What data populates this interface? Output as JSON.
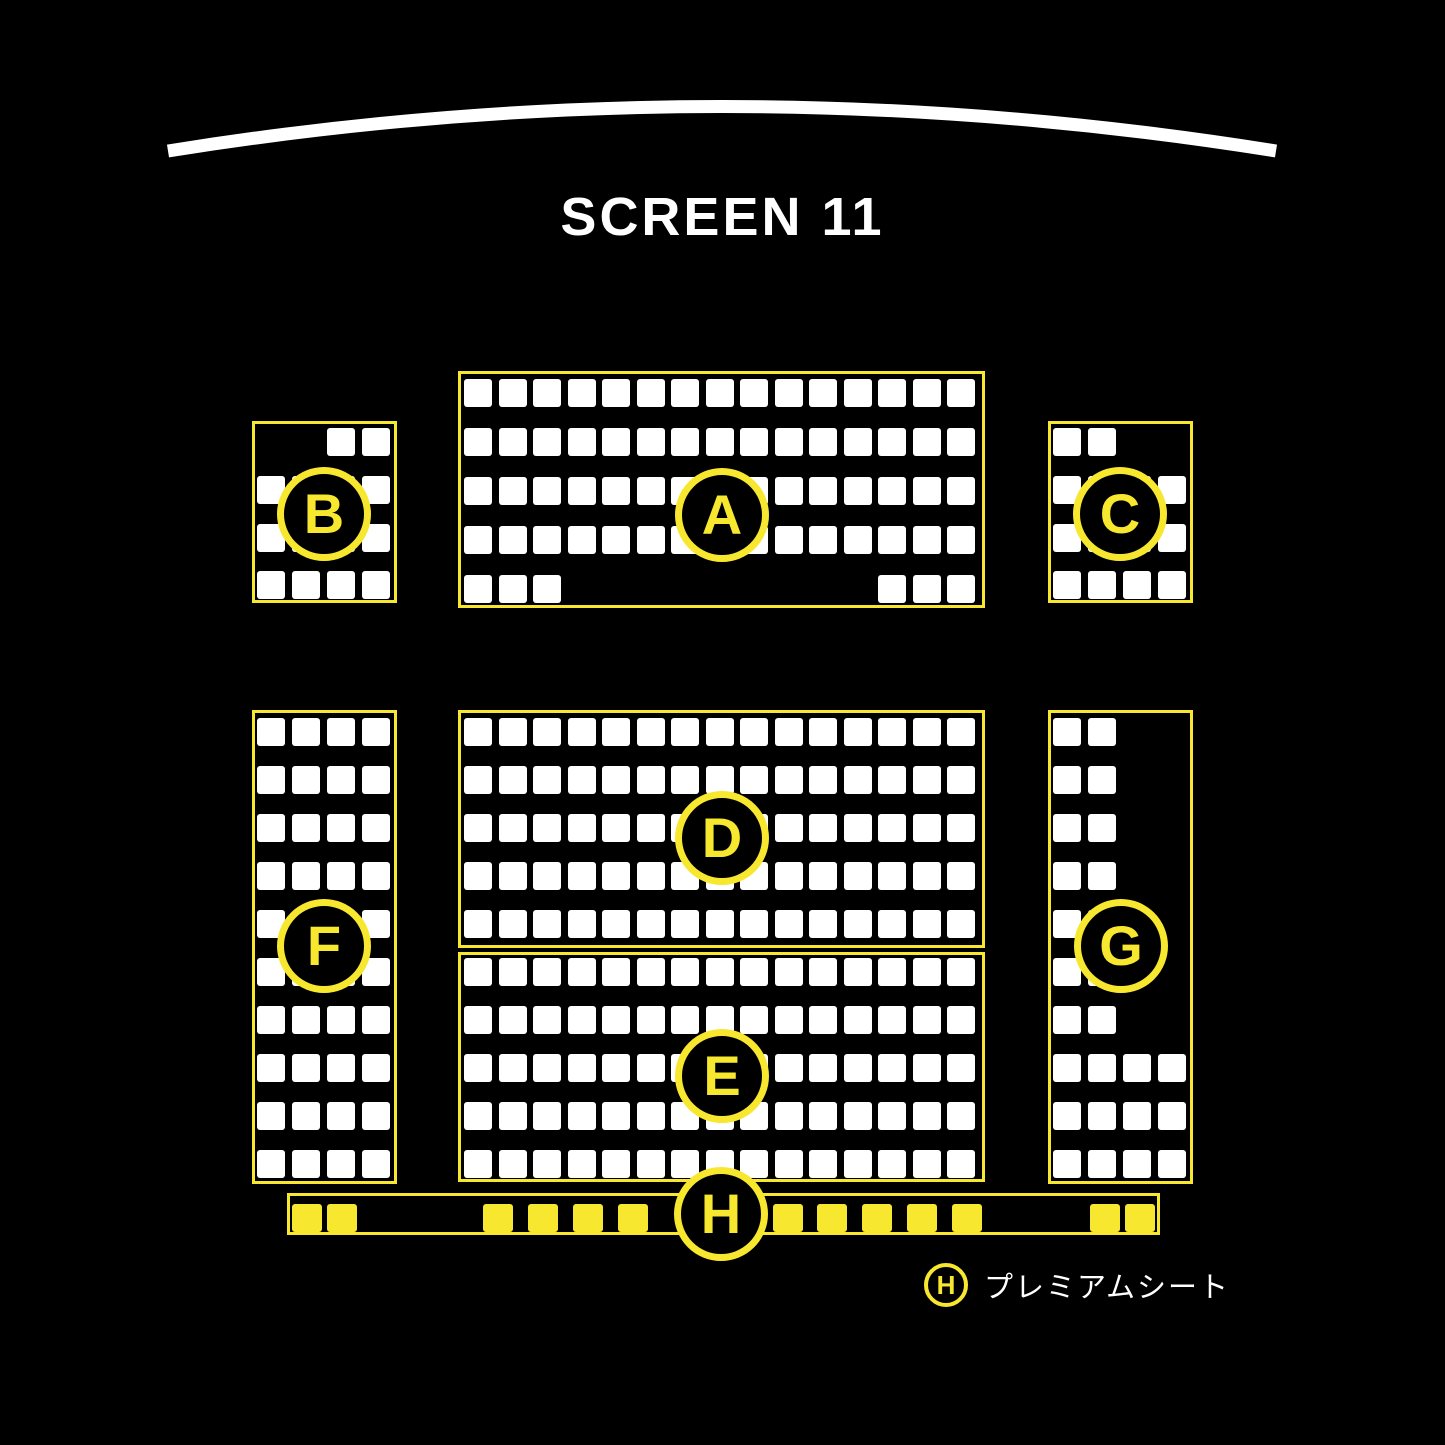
{
  "screen": {
    "title": "SCREEN 11"
  },
  "colors": {
    "accent_yellow": "#F7E82F",
    "seat_white": "#FFFFFF",
    "background": "#000000"
  },
  "legend": {
    "symbol": "H",
    "label": "プレミアムシート"
  },
  "arc": {
    "x1": 168,
    "y1": 151,
    "cx": 722,
    "cy": 62,
    "x2": 1276,
    "y2": 151,
    "stroke_width": 13
  },
  "sections": [
    {
      "label": "A",
      "seat_style": "standard",
      "seat_size": {
        "w": 28,
        "h": 28
      },
      "box": {
        "x": 458,
        "y": 371,
        "w": 527,
        "h": 237
      },
      "grid": {
        "col_start": 464,
        "col_pitch": 34.5,
        "col_count": 15,
        "rows": [
          {
            "y": 379,
            "cols": "all"
          },
          {
            "y": 428,
            "cols": "all"
          },
          {
            "y": 477,
            "cols": "all"
          },
          {
            "y": 526,
            "cols": "all"
          },
          {
            "y": 575,
            "cols": [
              1,
              2,
              3,
              13,
              14,
              15
            ]
          }
        ]
      },
      "circle": {
        "cx": 722,
        "cy": 515,
        "r": 47
      }
    },
    {
      "label": "B",
      "seat_style": "standard",
      "seat_size": {
        "w": 28,
        "h": 28
      },
      "box": {
        "x": 252,
        "y": 421,
        "w": 145,
        "h": 182
      },
      "grid": {
        "col_start": 257,
        "col_pitch": 35,
        "col_count": 4,
        "rows": [
          {
            "y": 428,
            "cols": [
              3,
              4
            ]
          },
          {
            "y": 476,
            "cols": "all"
          },
          {
            "y": 524,
            "cols": "all"
          },
          {
            "y": 571,
            "cols": "all"
          }
        ]
      },
      "circle": {
        "cx": 324,
        "cy": 514,
        "r": 47
      }
    },
    {
      "label": "C",
      "seat_style": "standard",
      "seat_size": {
        "w": 28,
        "h": 28
      },
      "box": {
        "x": 1048,
        "y": 421,
        "w": 145,
        "h": 182
      },
      "grid": {
        "col_start": 1053,
        "col_pitch": 35,
        "col_count": 4,
        "rows": [
          {
            "y": 428,
            "cols": [
              1,
              2
            ]
          },
          {
            "y": 476,
            "cols": "all"
          },
          {
            "y": 524,
            "cols": "all"
          },
          {
            "y": 571,
            "cols": "all"
          }
        ]
      },
      "circle": {
        "cx": 1120,
        "cy": 514,
        "r": 47
      }
    },
    {
      "label": "D",
      "seat_style": "standard",
      "seat_size": {
        "w": 28,
        "h": 28
      },
      "box": {
        "x": 458,
        "y": 710,
        "w": 527,
        "h": 238
      },
      "grid": {
        "col_start": 464,
        "col_pitch": 34.5,
        "col_count": 15,
        "rows": [
          {
            "y": 718,
            "cols": "all"
          },
          {
            "y": 766,
            "cols": "all"
          },
          {
            "y": 814,
            "cols": "all"
          },
          {
            "y": 862,
            "cols": "all"
          },
          {
            "y": 910,
            "cols": "all"
          }
        ]
      },
      "circle": {
        "cx": 722,
        "cy": 838,
        "r": 47
      }
    },
    {
      "label": "E",
      "seat_style": "standard",
      "seat_size": {
        "w": 28,
        "h": 28
      },
      "box": {
        "x": 458,
        "y": 952,
        "w": 527,
        "h": 230
      },
      "grid": {
        "col_start": 464,
        "col_pitch": 34.5,
        "col_count": 15,
        "rows": [
          {
            "y": 958,
            "cols": "all"
          },
          {
            "y": 1006,
            "cols": "all"
          },
          {
            "y": 1054,
            "cols": "all"
          },
          {
            "y": 1102,
            "cols": "all"
          },
          {
            "y": 1150,
            "cols": "all"
          }
        ]
      },
      "circle": {
        "cx": 722,
        "cy": 1076,
        "r": 47
      }
    },
    {
      "label": "F",
      "seat_style": "standard",
      "seat_size": {
        "w": 28,
        "h": 28
      },
      "box": {
        "x": 252,
        "y": 710,
        "w": 145,
        "h": 474
      },
      "grid": {
        "col_start": 257,
        "col_pitch": 35,
        "col_count": 4,
        "rows": [
          {
            "y": 718,
            "cols": "all"
          },
          {
            "y": 766,
            "cols": "all"
          },
          {
            "y": 814,
            "cols": "all"
          },
          {
            "y": 862,
            "cols": "all"
          },
          {
            "y": 910,
            "cols": "all"
          },
          {
            "y": 958,
            "cols": "all"
          },
          {
            "y": 1006,
            "cols": "all"
          },
          {
            "y": 1054,
            "cols": "all"
          },
          {
            "y": 1102,
            "cols": "all"
          },
          {
            "y": 1150,
            "cols": "all"
          }
        ]
      },
      "circle": {
        "cx": 324,
        "cy": 946,
        "r": 47
      }
    },
    {
      "label": "G",
      "seat_style": "standard",
      "seat_size": {
        "w": 28,
        "h": 28
      },
      "box": {
        "x": 1048,
        "y": 710,
        "w": 145,
        "h": 474
      },
      "grid": {
        "col_start": 1053,
        "col_pitch": 35,
        "col_count": 4,
        "rows": [
          {
            "y": 718,
            "cols": [
              1,
              2
            ]
          },
          {
            "y": 766,
            "cols": [
              1,
              2
            ]
          },
          {
            "y": 814,
            "cols": [
              1,
              2
            ]
          },
          {
            "y": 862,
            "cols": [
              1,
              2
            ]
          },
          {
            "y": 910,
            "cols": [
              1,
              2
            ]
          },
          {
            "y": 958,
            "cols": [
              1,
              2
            ]
          },
          {
            "y": 1006,
            "cols": [
              1,
              2
            ]
          },
          {
            "y": 1054,
            "cols": "all"
          },
          {
            "y": 1102,
            "cols": "all"
          },
          {
            "y": 1150,
            "cols": "all"
          }
        ]
      },
      "circle": {
        "cx": 1121,
        "cy": 946,
        "r": 47
      }
    },
    {
      "label": "H",
      "seat_style": "premium",
      "seat_size": {
        "w": 30,
        "h": 28
      },
      "box": {
        "x": 287,
        "y": 1193,
        "w": 873,
        "h": 42
      },
      "seats_abs": [
        {
          "x": 292,
          "y": 1204
        },
        {
          "x": 327,
          "y": 1204
        },
        {
          "x": 483,
          "y": 1204
        },
        {
          "x": 528,
          "y": 1204
        },
        {
          "x": 573,
          "y": 1204
        },
        {
          "x": 618,
          "y": 1204
        },
        {
          "x": 773,
          "y": 1204
        },
        {
          "x": 817,
          "y": 1204
        },
        {
          "x": 862,
          "y": 1204
        },
        {
          "x": 907,
          "y": 1204
        },
        {
          "x": 952,
          "y": 1204
        },
        {
          "x": 1090,
          "y": 1204
        },
        {
          "x": 1125,
          "y": 1204
        }
      ],
      "circle": {
        "cx": 721,
        "cy": 1214,
        "r": 47
      }
    }
  ]
}
